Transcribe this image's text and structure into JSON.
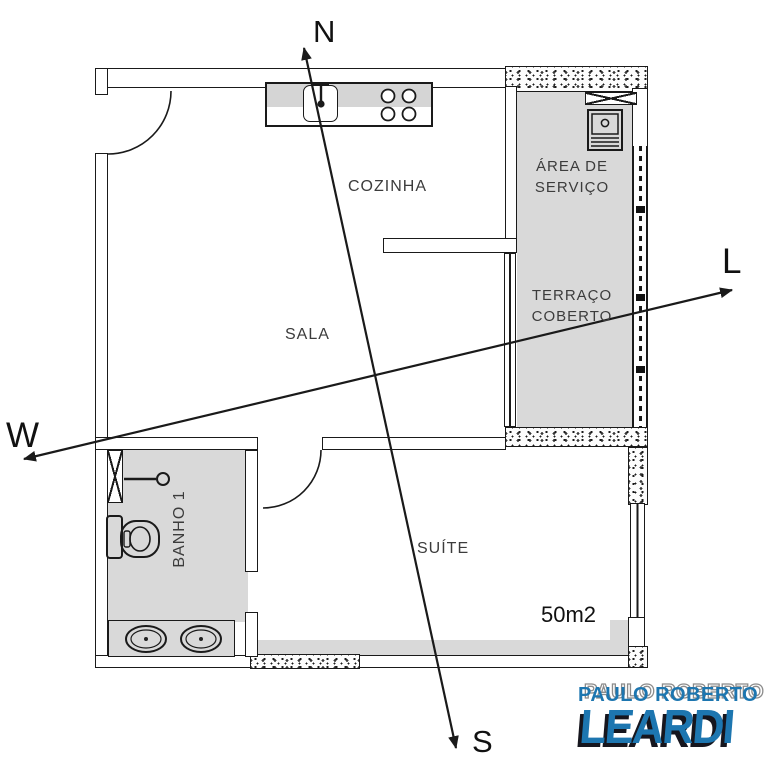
{
  "plan": {
    "rooms": {
      "cozinha": {
        "label": "COZINHA"
      },
      "sala": {
        "label": "SALA"
      },
      "area_servico": {
        "line1": "ÁREA DE",
        "line2": "SERVIÇO"
      },
      "terraco": {
        "line1": "TERRAÇO",
        "line2": "COBERTO"
      },
      "banho": {
        "label": "BANHO 1"
      },
      "suite": {
        "label": "SUÍTE"
      },
      "area_total": {
        "label": "50m2"
      }
    },
    "compass": {
      "north": "N",
      "south": "S",
      "west": "W",
      "east": "L"
    },
    "fixtures": {
      "kitchen": [
        "sink",
        "cooktop-4-burners"
      ],
      "service_area": [
        "laundry-tank"
      ],
      "bathroom": [
        "shower",
        "toilet",
        "double-vanity"
      ]
    }
  },
  "logo": {
    "name_top": "PAULO ROBERTO",
    "name_main": "LEARDI",
    "blue": "#1d76b0",
    "gray": "#8c8c8c",
    "shadow": "#16161e"
  },
  "colors": {
    "line": "#1a1a1a",
    "room_fill": "#d9d9d9",
    "label_text": "#3c3c3c"
  }
}
